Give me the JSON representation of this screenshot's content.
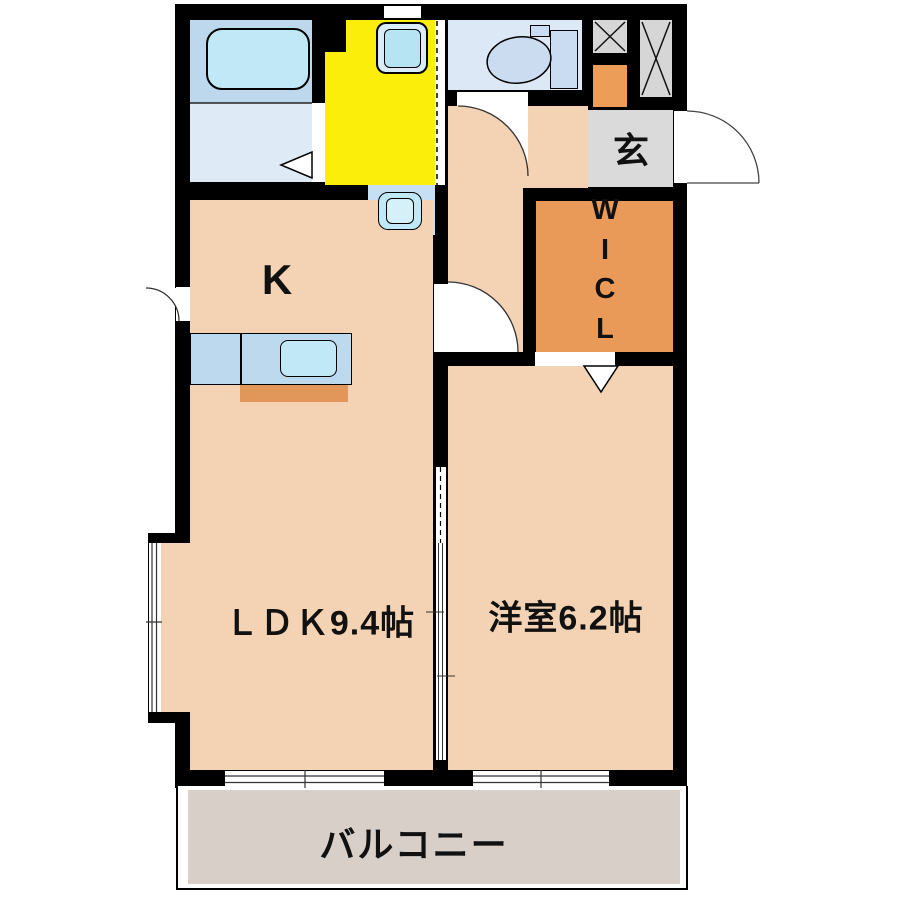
{
  "rooms": {
    "kitchen": {
      "label": "K"
    },
    "ldk": {
      "label": "ＬＤＫ9.4帖"
    },
    "western": {
      "label": "洋室6.2帖"
    },
    "entrance_genkan": {
      "label": "玄"
    },
    "wicl": {
      "letters": [
        "W",
        "I",
        "C",
        "L"
      ]
    },
    "balcony": {
      "label": "バルコニー"
    }
  },
  "colors": {
    "wall": "#000000",
    "text": "#111111",
    "room_peach": "#f3d3b4",
    "washroom_yellow": "#fbee0a",
    "wicl_orange": "#ea9a58",
    "shoe_box_orange": "#ec9e59",
    "counter_strip_orange": "#e2975a",
    "genkan_gray": "#dadada",
    "shaft_gray": "#d6d6d6",
    "balcony_gray": "#d8cfc9",
    "toilet_floor_blue": "#dce8f6",
    "bath_upper_blue": "#bdd8ed",
    "bath_lower_blue": "#dfeaf7",
    "basin_floor_blue": "#c6dff3",
    "fixture_cyan": "#c0e8f6",
    "counter_blue": "#bdd9ee",
    "washer_outer": "#d9edf8",
    "washer_inner": "#b7e4f3",
    "toilet_fixture_blue": "#c9dcf2"
  }
}
